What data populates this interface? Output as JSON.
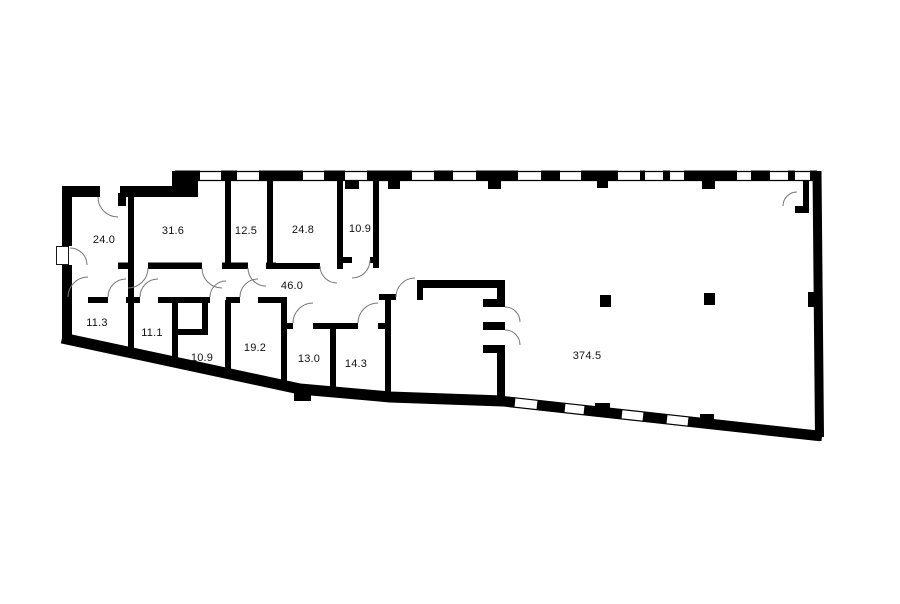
{
  "plan": {
    "type": "floor-plan",
    "wall_color": "#000000",
    "background_color": "#ffffff",
    "door_arc_color": "#777777",
    "label_color": "#111111",
    "rooms": [
      {
        "name": "room-24-0",
        "area": "24.0"
      },
      {
        "name": "room-31-6",
        "area": "31.6"
      },
      {
        "name": "room-12-5",
        "area": "12.5"
      },
      {
        "name": "room-24-8",
        "area": "24.8"
      },
      {
        "name": "room-10-9-top",
        "area": "10.9"
      },
      {
        "name": "corridor-46-0",
        "area": "46.0"
      },
      {
        "name": "room-11-3",
        "area": "11.3"
      },
      {
        "name": "room-11-1",
        "area": "11.1"
      },
      {
        "name": "room-10-9-bottom",
        "area": "10.9"
      },
      {
        "name": "room-19-2",
        "area": "19.2"
      },
      {
        "name": "room-13-0",
        "area": "13.0"
      },
      {
        "name": "room-14-3",
        "area": "14.3"
      },
      {
        "name": "hall-374-5",
        "area": "374.5"
      }
    ]
  }
}
